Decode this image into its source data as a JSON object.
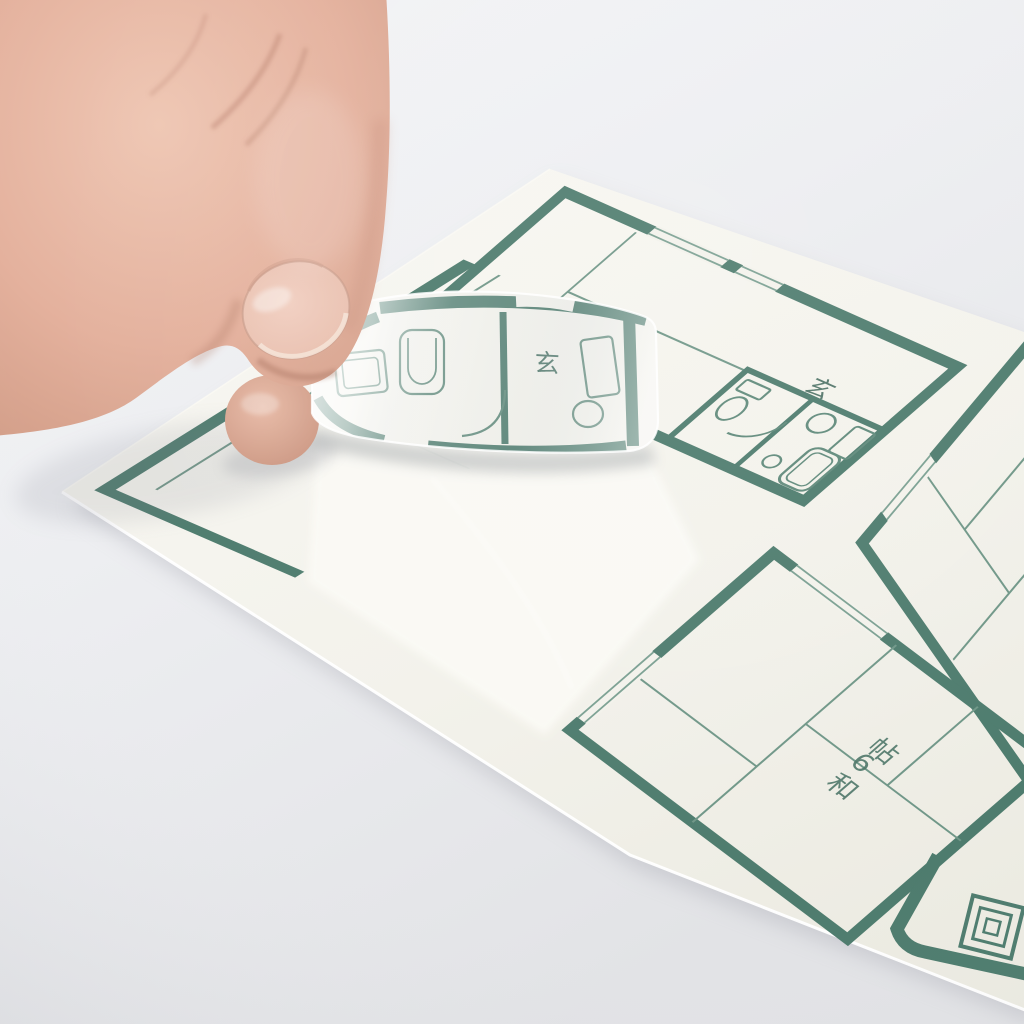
{
  "photo": {
    "alt": "A hand peels a curled floor-plan sticker off a white sticker sheet printed with dark-green apartment floor plans",
    "labels": {
      "room_large": "和6帖",
      "entrance_sheet": "玄",
      "entrance_sticker": "玄"
    },
    "colors": {
      "plan_ink": "#4d7c6e",
      "plan_ink_thin": "#6f9788",
      "sheet": "#f4f3ec",
      "background": "#eceef0",
      "skin": "#e5b19c",
      "nail": "#eac0ae"
    }
  }
}
